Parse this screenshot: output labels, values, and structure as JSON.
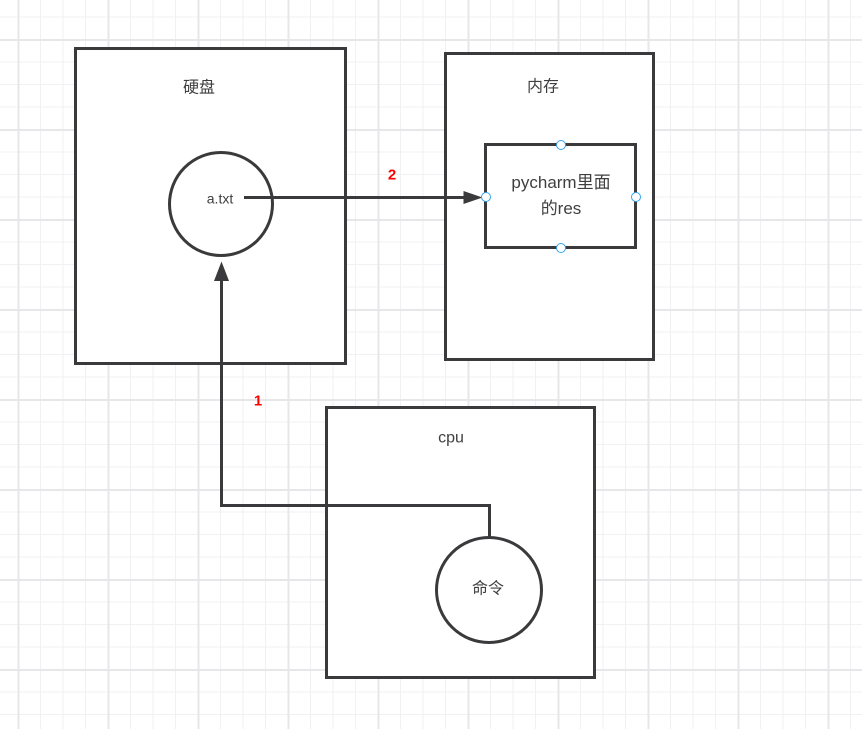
{
  "colors": {
    "stroke": "#3a3a3c",
    "text": "#3f3f41",
    "edge_label_red": "#ff0000",
    "selection_handle_blue": "#33a3f1",
    "grid_minor": "#f1f1f3",
    "grid_major": "#e7e7e9",
    "shape_fill": "#ffffff"
  },
  "shapes": {
    "disk_box": {
      "label": "硬盘"
    },
    "file_circle": {
      "label": "a.txt"
    },
    "memory_box": {
      "label": "内存"
    },
    "res_box": {
      "label_line1": "pycharm里面",
      "label_line2": "的res"
    },
    "cpu_box": {
      "label": "cpu"
    },
    "command_circle": {
      "label": "命令"
    }
  },
  "edges": {
    "edge1": {
      "label": "1"
    },
    "edge2": {
      "label": "2"
    }
  }
}
